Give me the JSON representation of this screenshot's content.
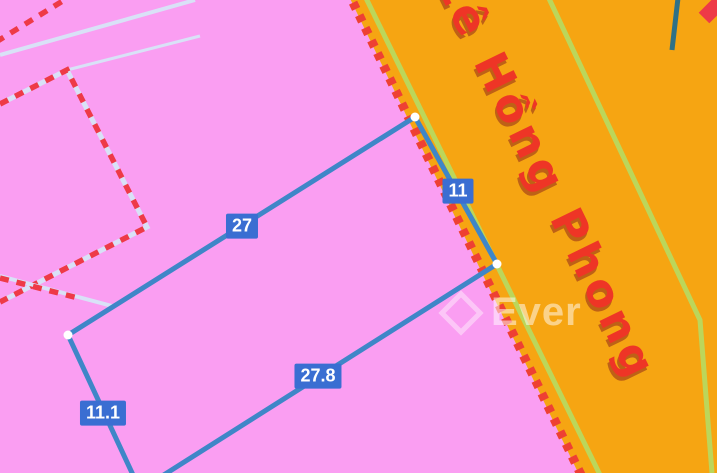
{
  "colors": {
    "pink_parcel_area": "#fa9ef2",
    "orange_road": "#f6a512",
    "parcel_boundary_red": "#ee3a47",
    "road_dash_red": "#ee4033",
    "road_edge_green": "#bcd65a",
    "survey_line_blue": "#3f86c8",
    "measure_label_blue": "#3a6ed2",
    "road_name_red": "#ee3526",
    "pale_boundary_blue": "#d9e1f7",
    "utility_line_teal": "#2f7187",
    "vertex_dot_white": "#ffffff"
  },
  "road": {
    "name": "Lê Hồng Phong"
  },
  "measurements": {
    "left": "27",
    "top": "11",
    "right": "27.8",
    "bottom": "11.1"
  },
  "watermark": {
    "brand": "Ever"
  }
}
